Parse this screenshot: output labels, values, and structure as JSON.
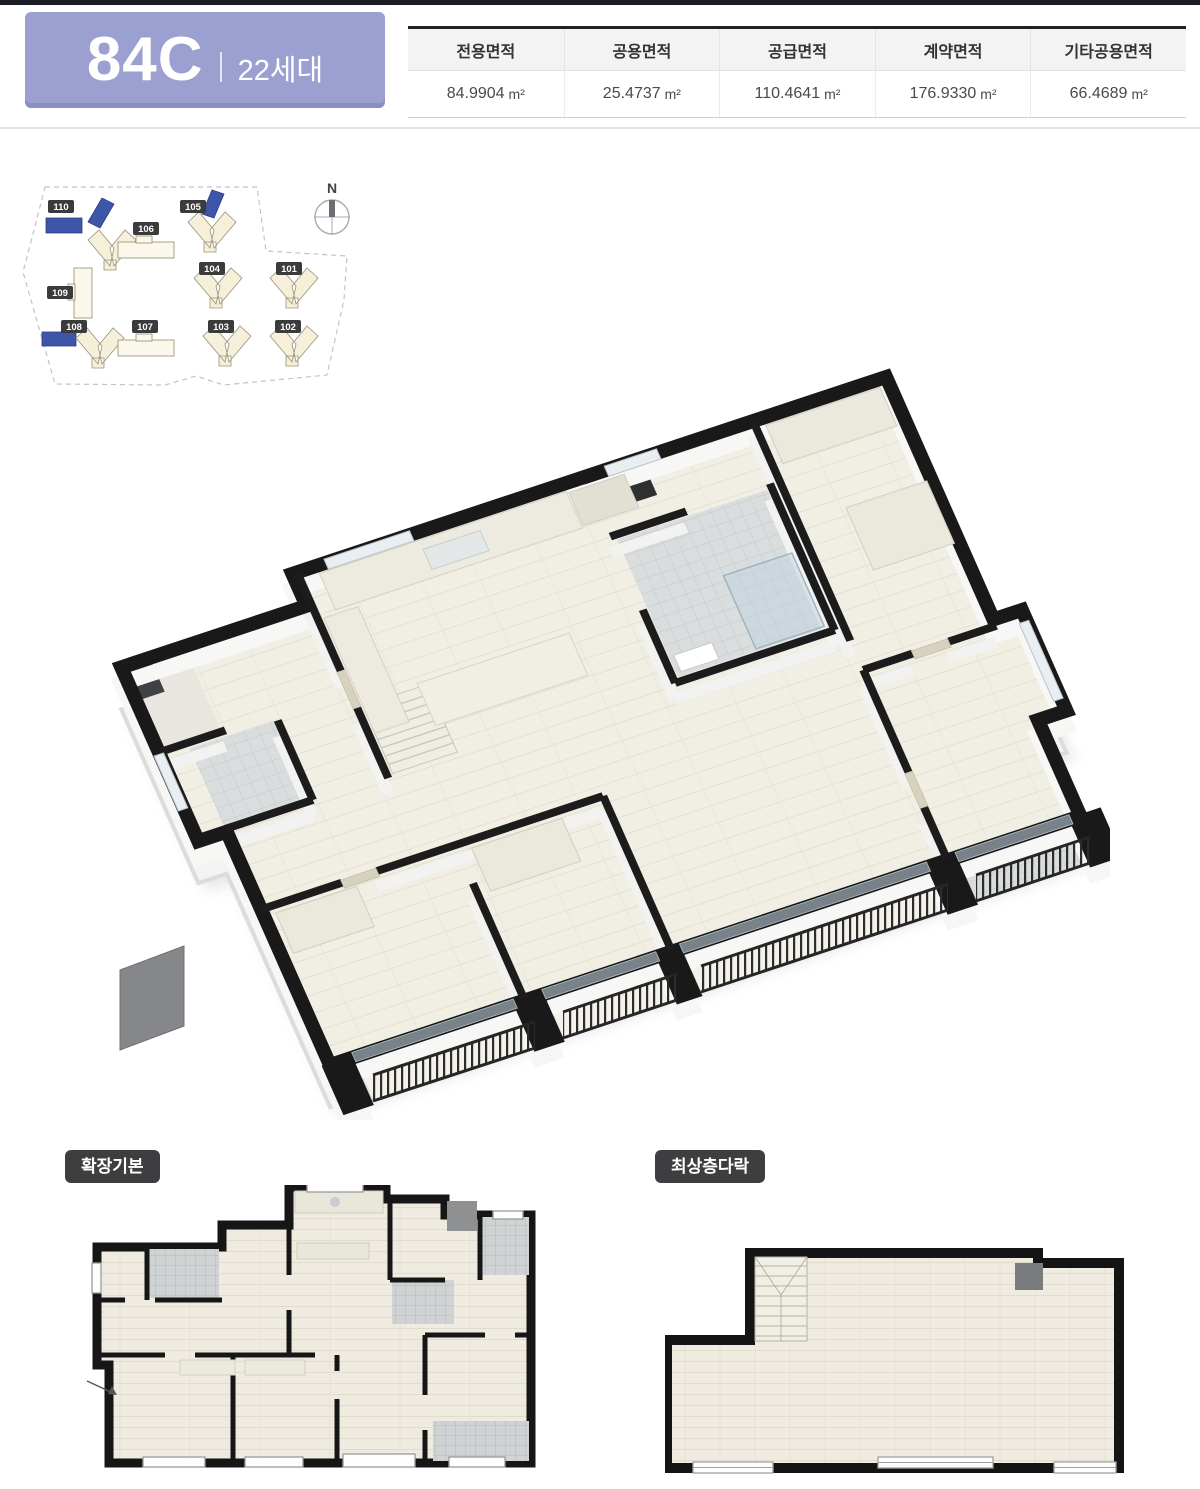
{
  "header": {
    "unit_code": "84C",
    "unit_households": "22세대",
    "badge_color": "#9ca0d0",
    "area_table": {
      "columns": [
        {
          "label": "전용면적",
          "value": "84.9904",
          "unit": "m²"
        },
        {
          "label": "공용면적",
          "value": "25.4737",
          "unit": "m²"
        },
        {
          "label": "공급면적",
          "value": "110.4641",
          "unit": "m²"
        },
        {
          "label": "계약면적",
          "value": "176.9330",
          "unit": "m²"
        },
        {
          "label": "기타공용면적",
          "value": "66.4689",
          "unit": "m²"
        }
      ]
    }
  },
  "site_plan": {
    "compass_label": "N",
    "highlight_color": "#3d56a9",
    "buildings": [
      {
        "id": "110",
        "highlighted": true
      },
      {
        "id": "106",
        "highlighted": false
      },
      {
        "id": "105",
        "highlighted": true
      },
      {
        "id": "109",
        "highlighted": false
      },
      {
        "id": "104",
        "highlighted": false
      },
      {
        "id": "101",
        "highlighted": false
      },
      {
        "id": "108",
        "highlighted": true
      },
      {
        "id": "107",
        "highlighted": false
      },
      {
        "id": "103",
        "highlighted": false
      },
      {
        "id": "102",
        "highlighted": false
      }
    ]
  },
  "floor_plans": {
    "variant_left_label": "확장기본",
    "variant_right_label": "최상층다락"
  },
  "colors": {
    "wall": "#191919",
    "floor": "#f1eee4",
    "accent_badge": "#9ca0d0",
    "building_highlight": "#3d56a9"
  }
}
